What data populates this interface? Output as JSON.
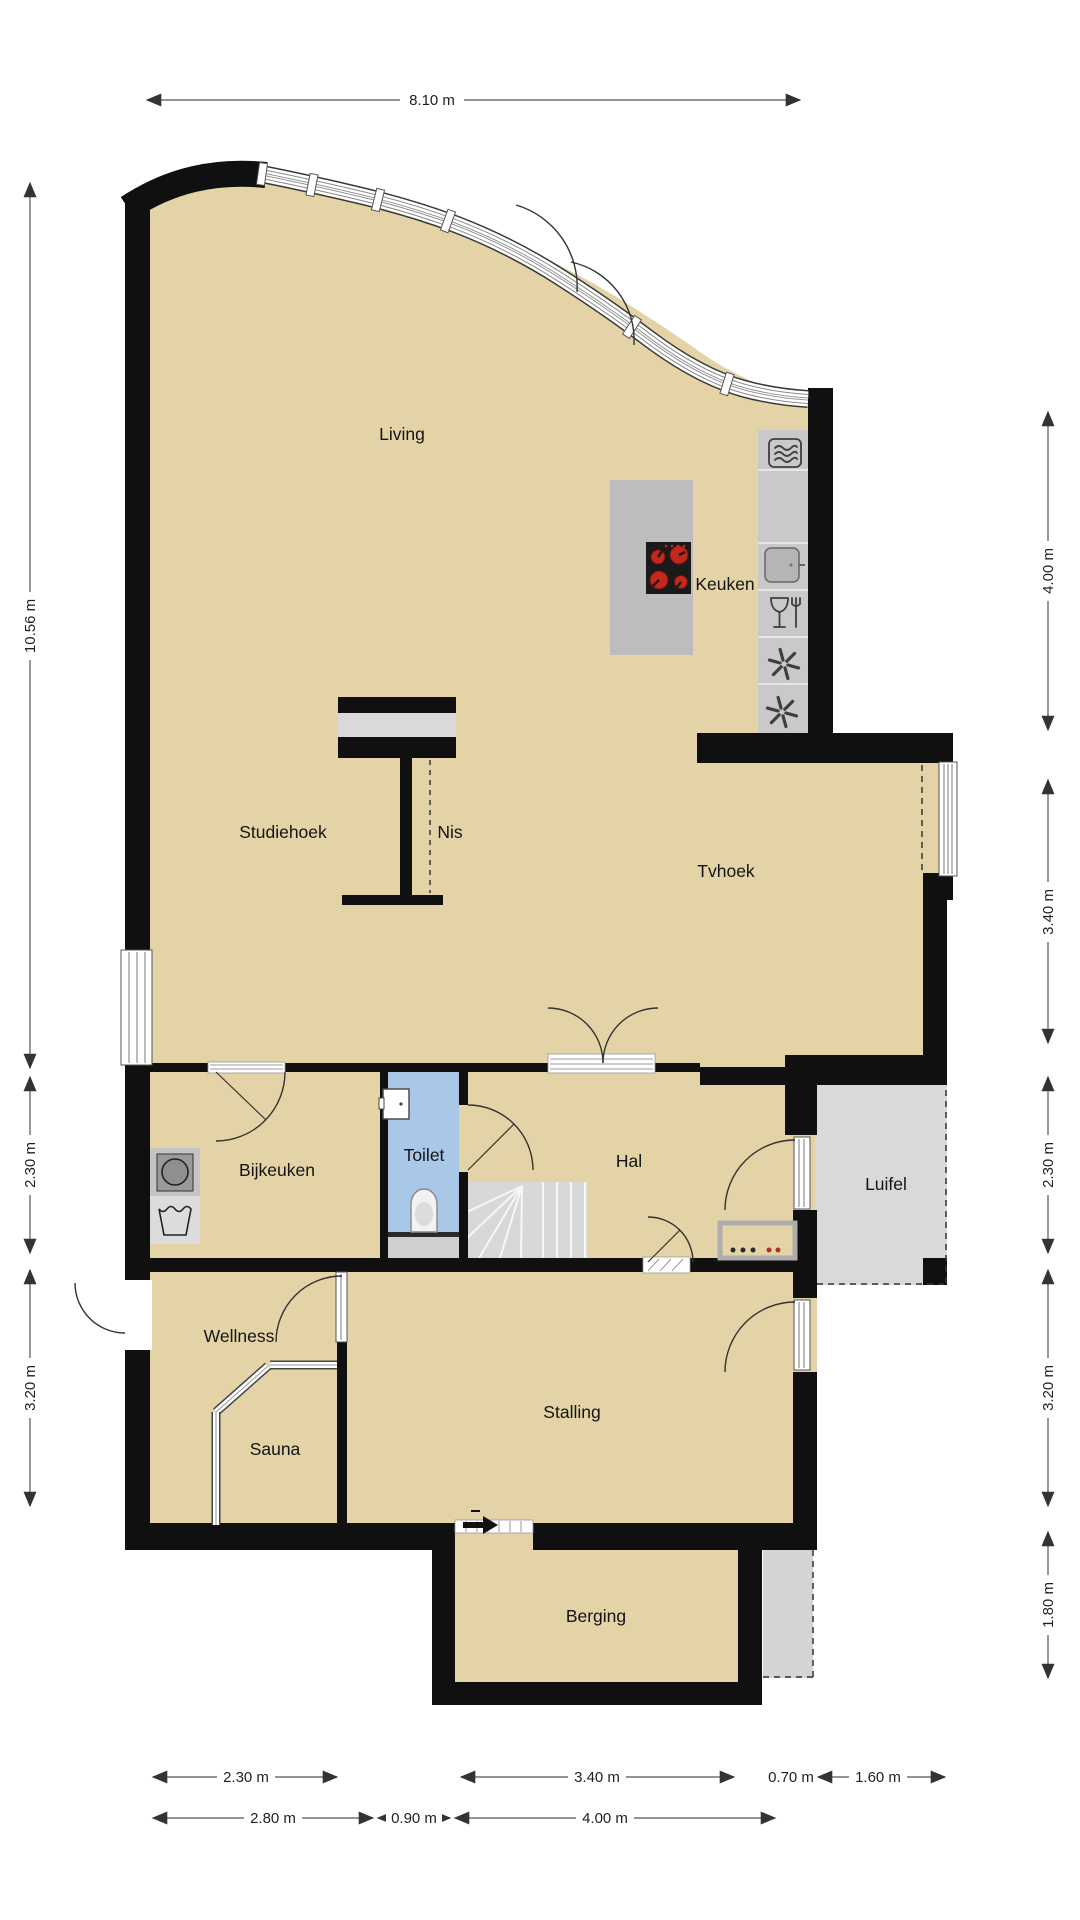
{
  "plan": {
    "title": "Floor plan ground floor",
    "rooms": {
      "living": "Living",
      "keuken": "Keuken",
      "studiehoek": "Studiehoek",
      "nis": "Nis",
      "tvhoek": "Tvhoek",
      "bijkeuken": "Bijkeuken",
      "toilet": "Toilet",
      "hal": "Hal",
      "luifel": "Luifel",
      "wellness": "Wellness",
      "sauna": "Sauna",
      "stalling": "Stalling",
      "berging": "Berging"
    },
    "dimensions": {
      "top": "8.10 m",
      "left": [
        "10.56 m",
        "2.30 m",
        "3.20 m"
      ],
      "right": [
        "4.00 m",
        "3.40 m",
        "2.30 m",
        "3.20 m",
        "1.80 m"
      ],
      "bottom_row1": [
        "2.30 m",
        "3.40 m",
        "0.70 m",
        "1.60 m"
      ],
      "bottom_row2": [
        "2.80 m",
        "0.90 m",
        "4.00 m"
      ]
    },
    "icons": {
      "cooktop": "cooktop-4-burners",
      "oven": "oven-microwave",
      "sink": "kitchen-sink",
      "dishwasher": "glass-and-fork",
      "freezer": "snowflake",
      "washer": "washing-machine",
      "handwash": "laundry-tub",
      "washbasin": "small-washbasin",
      "wc": "toilet-bowl",
      "stairs": "winder-staircase",
      "entrance_arrow": "entrance-arrow",
      "doormat": "mat-with-dots"
    },
    "colors": {
      "wall": "#101010",
      "floor": "#e3d3a6",
      "toilet_floor": "#a9c7e6",
      "canopy": "#d9d9d9",
      "counter": "#c9c9c9",
      "island": "#bdbdbd",
      "stairs": "#d8d8d8",
      "paving": "#d4d4d4",
      "burner": "#c2281e",
      "dim_line": "#555555",
      "label_text": "#141414"
    }
  }
}
